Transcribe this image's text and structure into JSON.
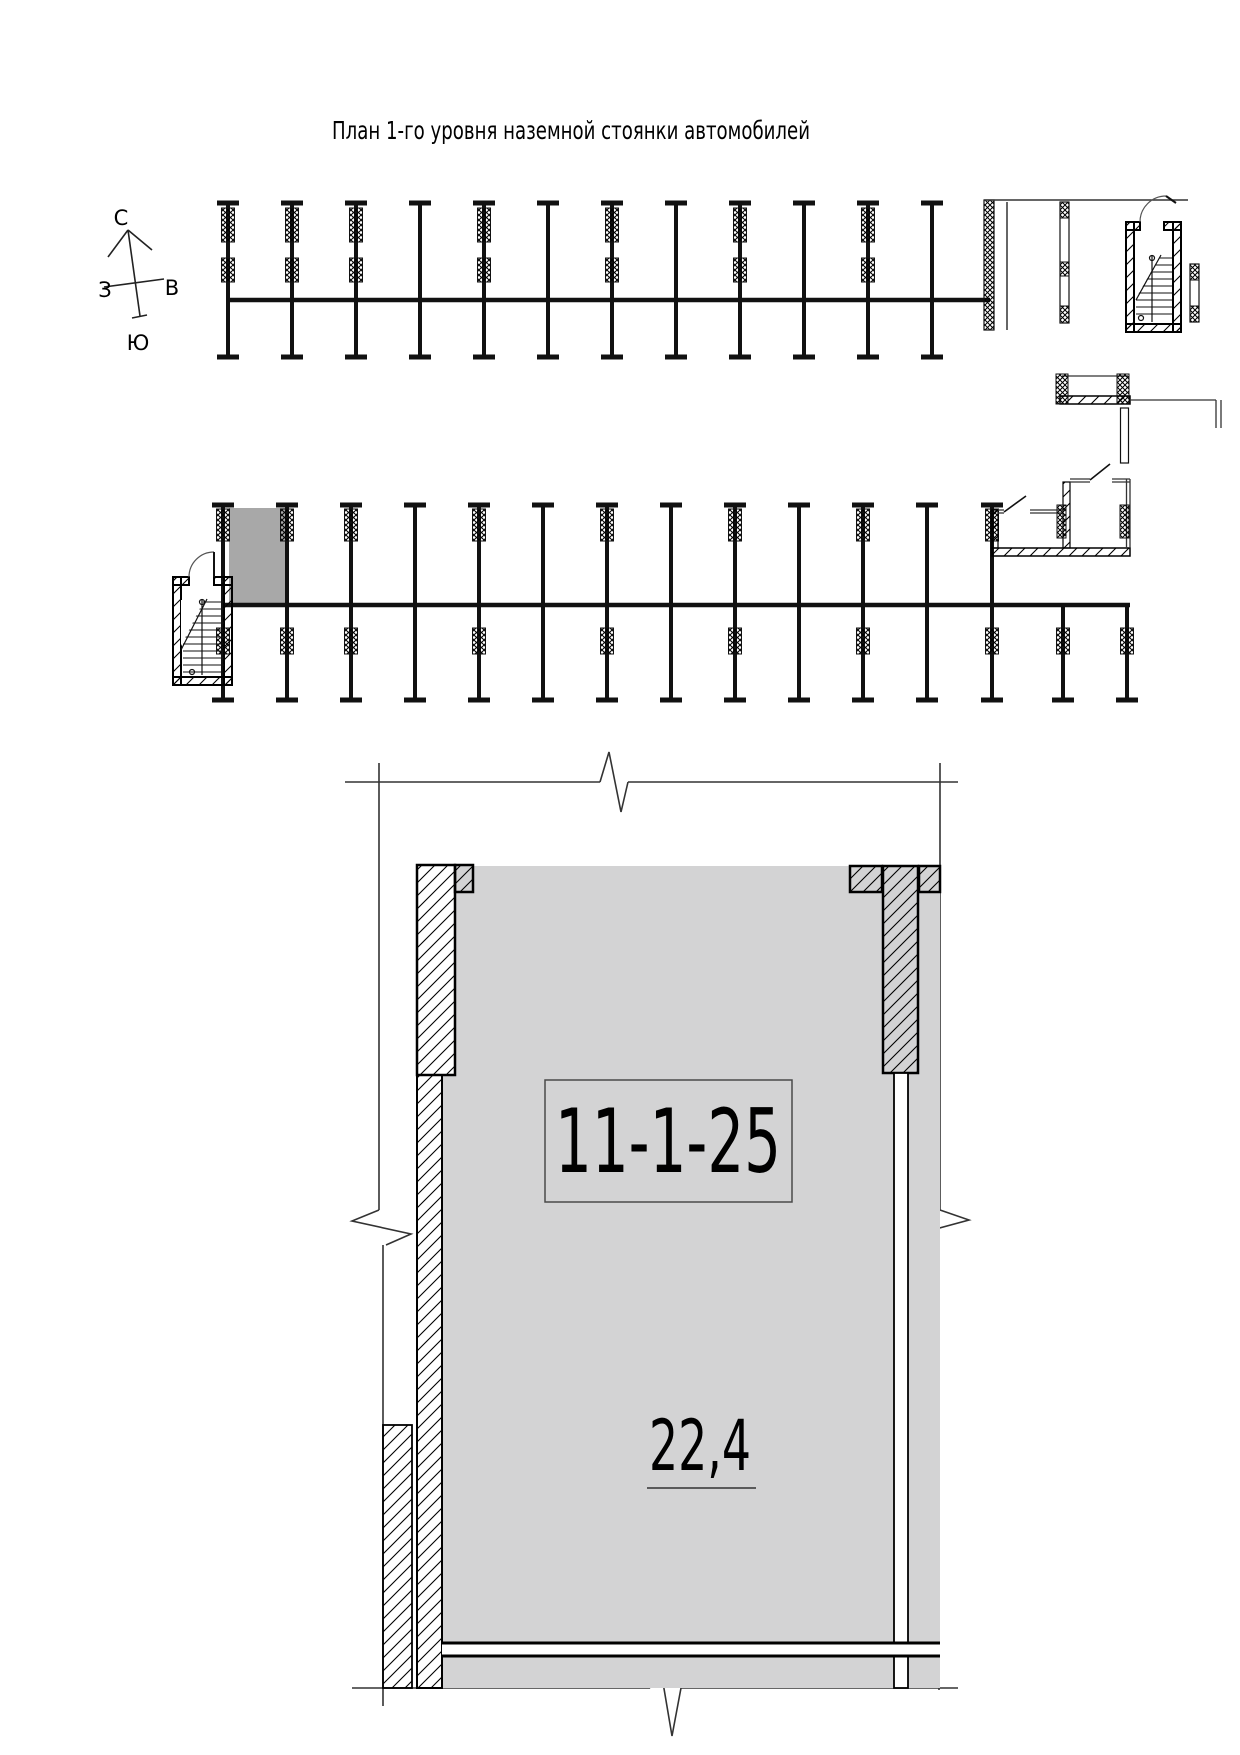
{
  "title": "План 1-го уровня наземной стоянки автомобилей",
  "compass": {
    "north": "С",
    "south": "Ю",
    "west": "З",
    "east": "В"
  },
  "spot": {
    "number": "11-1-25",
    "area": "22,4"
  },
  "colors": {
    "line": "#000000",
    "thin_line": "#333333",
    "floor_gray": "#d3d3d4",
    "highlight_gray": "#a8a8a8",
    "wall_white": "#ffffff"
  }
}
